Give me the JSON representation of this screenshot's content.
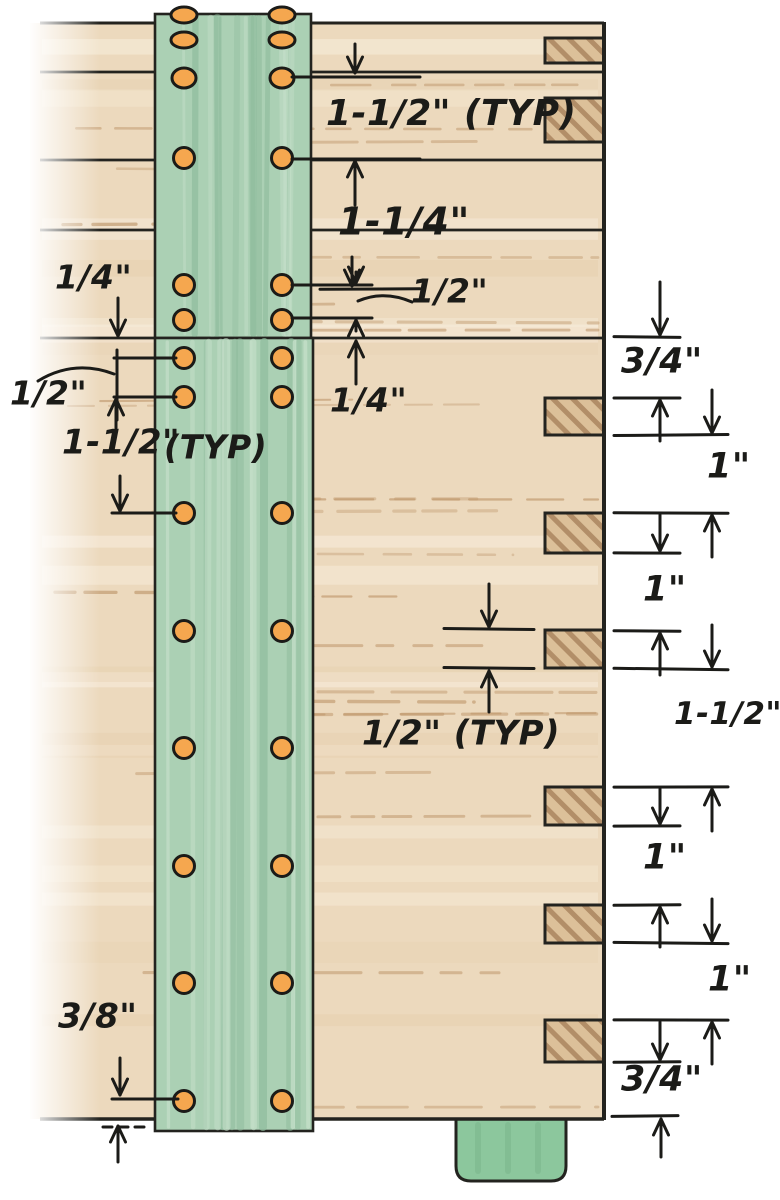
{
  "figure_labels": {
    "top_spacing": "1-1/2\" (TYP)",
    "top_second": "1-1/4\"",
    "top_half": "1/2\"",
    "mid_quarter": "1/4\"",
    "left_quarter": "1/4\"",
    "left_half": "1/2\"",
    "left_spacing": "1-1/2\"",
    "left_typ": "(TYP)",
    "notch_typ": "1/2\" (TYP)",
    "left_bottom": "3/8\"",
    "right_col": [
      "3/4\"",
      "1\"",
      "1\"",
      "1-1/2\"",
      "1\"",
      "1\"",
      "3/4\""
    ]
  },
  "colors": {
    "background": "#ffffff",
    "wood": "#ecd9bd",
    "wood_light": "#f8eedd",
    "wood_shade": "#e3cba8",
    "grain": "#bd9468",
    "notch_fill": "#dcc099",
    "notch_hatch": "#a8825b",
    "cleat_green": "#abd0b4",
    "cleat_light": "#c9e2cd",
    "cleat_dark": "#8fbc9d",
    "tenon_green": "#8cc79d",
    "tenon_dark": "#76b389",
    "outline": "#23231f",
    "ink": "#1b1b18",
    "screw": "#f5a74f"
  },
  "board": {
    "x": 30,
    "top": 23,
    "right": 604,
    "bottom": 1119,
    "seam_x1": 40,
    "seams": [
      72,
      160,
      230,
      338
    ]
  },
  "notch_x": 545,
  "notch_w": 59,
  "notches": [
    {
      "y": 38,
      "h": 25
    },
    {
      "y": 98,
      "h": 44
    },
    {
      "y": 398,
      "h": 37
    },
    {
      "y": 513,
      "h": 40
    },
    {
      "y": 630,
      "h": 38
    },
    {
      "y": 787,
      "h": 38
    },
    {
      "y": 905,
      "h": 38
    },
    {
      "y": 1020,
      "h": 42
    }
  ],
  "cleats": {
    "upper": {
      "x": 155,
      "y": 14,
      "w": 156,
      "h": 324
    },
    "lower": {
      "x": 155,
      "y": 338,
      "w": 158,
      "h": 793
    },
    "screw_cols": [
      184,
      282
    ],
    "upper_rows": [
      15,
      40,
      78,
      158,
      285,
      320
    ],
    "lower_rows": [
      358,
      397,
      513,
      631,
      748,
      866,
      983,
      1101
    ]
  },
  "tenon": {
    "x": 456,
    "y": 1119,
    "w": 110,
    "h": 62,
    "r": 15
  },
  "annotations": {
    "labels": [
      {
        "key": "top_spacing",
        "text": "1-1/2\" (TYP)",
        "x": 326,
        "y": 97,
        "size": 36
      },
      {
        "key": "top_second",
        "text": "1-1/4\"",
        "x": 338,
        "y": 205,
        "size": 38
      },
      {
        "key": "top_half",
        "text": "1/2\"",
        "x": 411,
        "y": 277,
        "size": 33
      },
      {
        "key": "mid_quarter",
        "text": "1/4\"",
        "x": 330,
        "y": 386,
        "size": 33
      },
      {
        "key": "left_quarter",
        "text": "1/4\"",
        "x": 55,
        "y": 263,
        "size": 33
      },
      {
        "key": "left_half",
        "text": "1/2\"",
        "x": 10,
        "y": 379,
        "size": 33
      },
      {
        "key": "left_spacing",
        "text": "1-1/2\"",
        "x": 62,
        "y": 427,
        "size": 34
      },
      {
        "key": "left_typ",
        "text": "(TYP)",
        "x": 164,
        "y": 433,
        "size": 33
      },
      {
        "key": "notch_typ",
        "text": "1/2\" (TYP)",
        "x": 362,
        "y": 718,
        "size": 34
      },
      {
        "key": "left_bottom",
        "text": "3/8\"",
        "x": 58,
        "y": 1001,
        "size": 34
      },
      {
        "key": "right_1",
        "text": "3/4\"",
        "x": 621,
        "y": 345,
        "size": 35
      },
      {
        "key": "right_2",
        "text": "1\"",
        "x": 707,
        "y": 450,
        "size": 35
      },
      {
        "key": "right_3",
        "text": "1\"",
        "x": 643,
        "y": 573,
        "size": 35
      },
      {
        "key": "right_4",
        "text": "1-1/2\"",
        "x": 674,
        "y": 700,
        "size": 31
      },
      {
        "key": "right_5",
        "text": "1\"",
        "x": 643,
        "y": 841,
        "size": 35
      },
      {
        "key": "right_6",
        "text": "1\"",
        "x": 708,
        "y": 963,
        "size": 35
      },
      {
        "key": "right_7",
        "text": "3/4\"",
        "x": 621,
        "y": 1063,
        "size": 35
      }
    ],
    "leaders": [
      {
        "y": 77,
        "x1": 292,
        "x2": 420
      },
      {
        "y": 159,
        "x1": 292,
        "x2": 420
      },
      {
        "y": 285,
        "x1": 292,
        "x2": 372
      },
      {
        "y": 318,
        "x1": 292,
        "x2": 372
      },
      {
        "y": 358,
        "x1": 114,
        "x2": 176
      },
      {
        "y": 397,
        "x1": 114,
        "x2": 176
      },
      {
        "y": 513,
        "x1": 112,
        "x2": 176
      },
      {
        "y": 1099,
        "x1": 112,
        "x2": 178
      }
    ],
    "ticks": [
      {
        "y": 289,
        "x1": 320,
        "x2": 420
      },
      {
        "y": 629,
        "x1": 444,
        "x2": 534
      },
      {
        "y": 668,
        "x1": 444,
        "x2": 534
      },
      {
        "y": 337,
        "x1": 614,
        "x2": 680
      },
      {
        "y": 398,
        "x1": 614,
        "x2": 680
      },
      {
        "y": 435,
        "x1": 614,
        "x2": 728
      },
      {
        "y": 513,
        "x1": 614,
        "x2": 728
      },
      {
        "y": 553,
        "x1": 614,
        "x2": 680
      },
      {
        "y": 631,
        "x1": 614,
        "x2": 680
      },
      {
        "y": 669,
        "x1": 614,
        "x2": 728
      },
      {
        "y": 787,
        "x1": 614,
        "x2": 728
      },
      {
        "y": 826,
        "x1": 614,
        "x2": 680
      },
      {
        "y": 905,
        "x1": 614,
        "x2": 680
      },
      {
        "y": 943,
        "x1": 614,
        "x2": 728
      },
      {
        "y": 1020,
        "x1": 614,
        "x2": 728
      },
      {
        "y": 1062,
        "x1": 614,
        "x2": 680
      },
      {
        "y": 1116,
        "x1": 612,
        "x2": 678
      }
    ],
    "vlines": [
      {
        "x": 117,
        "y1": 350,
        "y2": 420
      }
    ],
    "arrows": [
      {
        "x": 355,
        "y1": 44,
        "y2": 73
      },
      {
        "x": 355,
        "y1": 205,
        "y2": 161
      },
      {
        "x": 352,
        "y1": 257,
        "y2": 286
      },
      {
        "x": 356,
        "y1": 272,
        "y2": 283
      },
      {
        "x": 356,
        "y1": 331,
        "y2": 320
      },
      {
        "x": 356,
        "y1": 384,
        "y2": 341
      },
      {
        "x": 118,
        "y1": 298,
        "y2": 336
      },
      {
        "x": 116,
        "y1": 428,
        "y2": 399
      },
      {
        "x": 120,
        "y1": 476,
        "y2": 511
      },
      {
        "x": 120,
        "y1": 1058,
        "y2": 1095
      },
      {
        "x": 118,
        "y1": 1162,
        "y2": 1126
      },
      {
        "x": 489,
        "y1": 584,
        "y2": 627
      },
      {
        "x": 489,
        "y1": 712,
        "y2": 671
      },
      {
        "x": 660,
        "y1": 282,
        "y2": 335
      },
      {
        "x": 660,
        "y1": 441,
        "y2": 400
      },
      {
        "x": 712,
        "y1": 390,
        "y2": 433
      },
      {
        "x": 660,
        "y1": 515,
        "y2": 551
      },
      {
        "x": 712,
        "y1": 557,
        "y2": 515
      },
      {
        "x": 660,
        "y1": 675,
        "y2": 633
      },
      {
        "x": 712,
        "y1": 625,
        "y2": 667
      },
      {
        "x": 660,
        "y1": 789,
        "y2": 824
      },
      {
        "x": 712,
        "y1": 831,
        "y2": 789
      },
      {
        "x": 660,
        "y1": 947,
        "y2": 907
      },
      {
        "x": 712,
        "y1": 899,
        "y2": 941
      },
      {
        "x": 660,
        "y1": 1022,
        "y2": 1060
      },
      {
        "x": 712,
        "y1": 1064,
        "y2": 1022
      },
      {
        "x": 661,
        "y1": 1157,
        "y2": 1119
      }
    ],
    "curves": [
      {
        "d": "M 412 302 Q 384 290 358 301"
      },
      {
        "d": "M 38 381 Q 74 359 114 374"
      }
    ],
    "dashed_ticks": [
      {
        "x1": 103,
        "x2": 150,
        "y": 1127
      }
    ]
  }
}
